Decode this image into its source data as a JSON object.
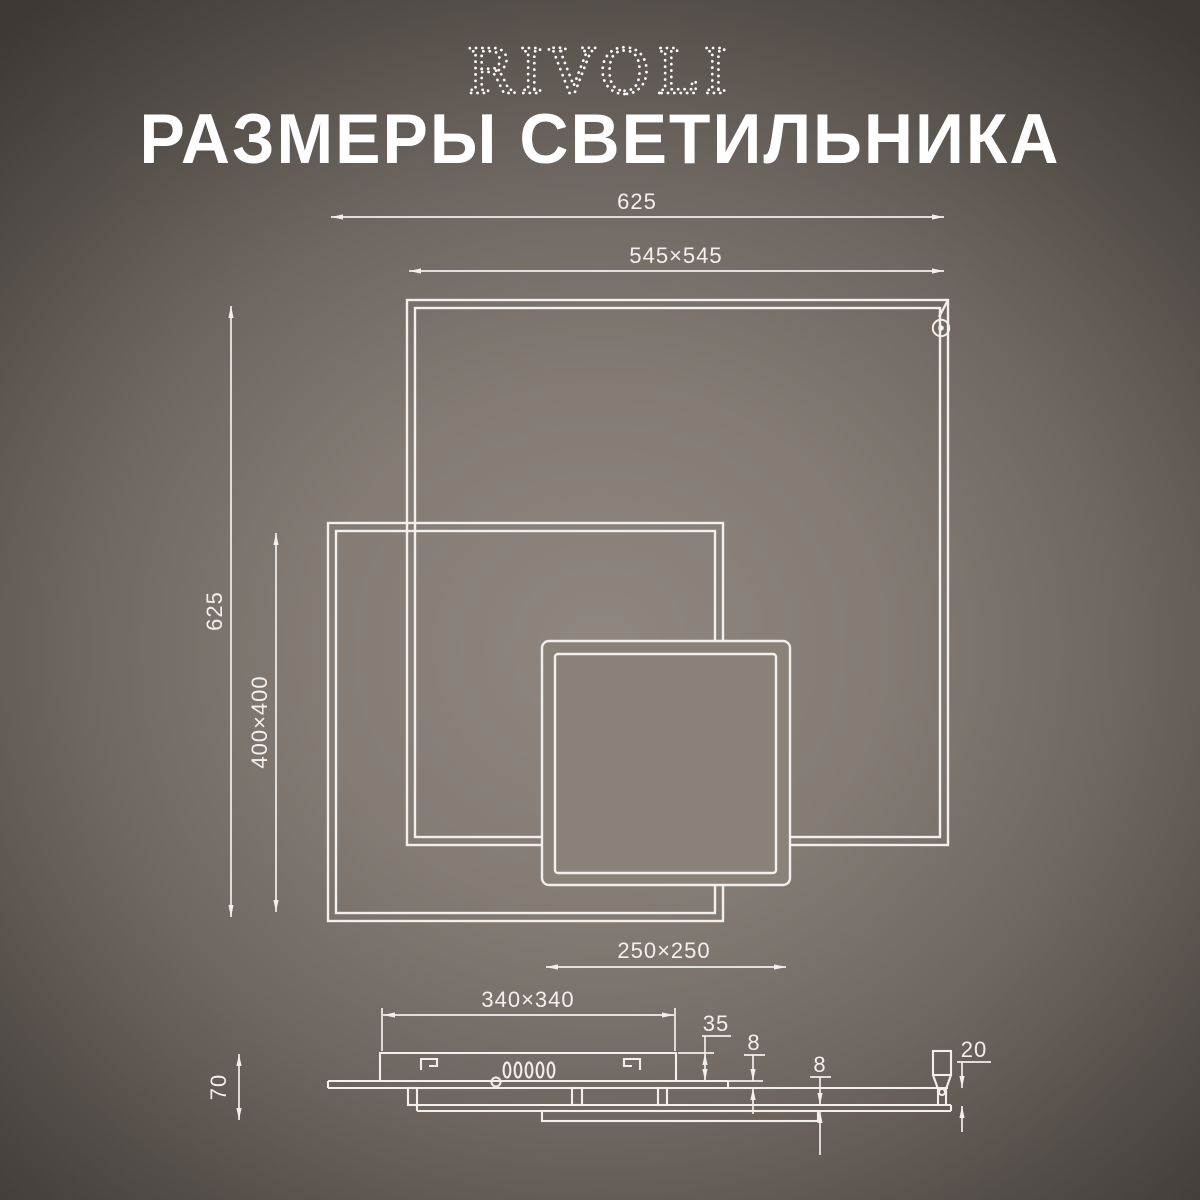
{
  "colors": {
    "bg_center": "#8e867f",
    "bg_edge": "#3e3935",
    "line": "#f2efec",
    "title_text": "#ffffff"
  },
  "brand": {
    "logo": "RIVOLI"
  },
  "header": {
    "title": "РАЗМЕРЫ СВЕТИЛЬНИКА"
  },
  "plan_view": {
    "dim_total_width": "625",
    "dim_outer_frame": "545×545",
    "dim_total_height": "625",
    "dim_middle_frame": "400×400",
    "dim_inner_frame": "250×250"
  },
  "side_view": {
    "dim_canopy_width": "340×340",
    "dim_canopy_height": "35",
    "dim_frame_thickness_top": "8",
    "dim_frame_thickness_mid": "8",
    "dim_bottom_gap": "20",
    "dim_total_height": "70"
  }
}
